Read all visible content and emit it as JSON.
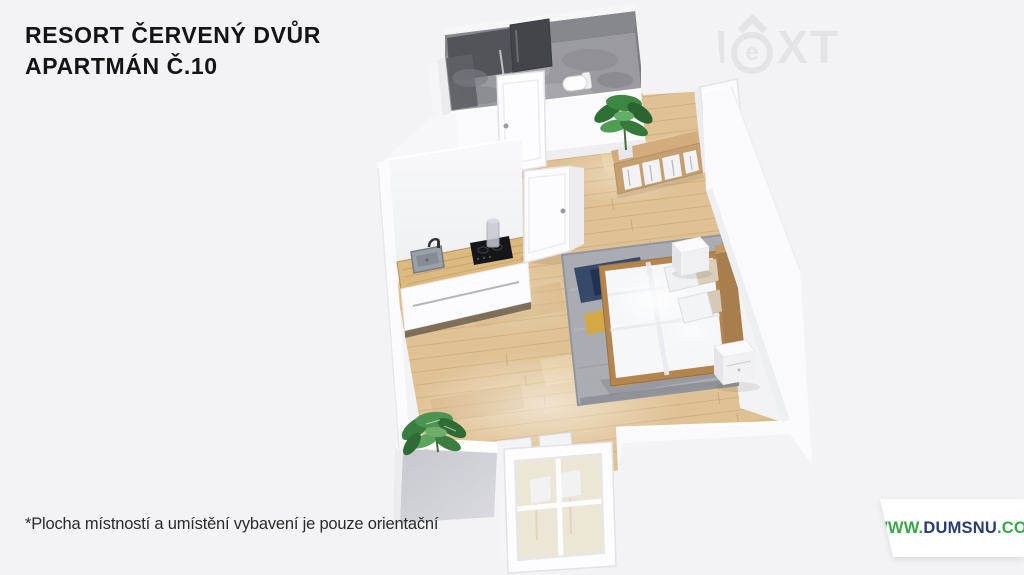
{
  "header": {
    "title_line1": "RESORT ČERVENÝ DVŮR",
    "title_line2": "APARTMÁN Č.10"
  },
  "watermark": {
    "part1": "N",
    "part2": "e",
    "part3": "XT",
    "color": "#e4e4e7"
  },
  "footnote": {
    "text": "*Plocha místností a umístění vybavení je pouze orientační"
  },
  "website": {
    "prefix": "WWW.",
    "domain": "DUMSNU",
    "suffix": ".COM",
    "prefix_color": "#3aa64a",
    "domain_color": "#273f6a"
  },
  "background_color": "#f3f3f5",
  "floor_plan": {
    "view": "3d-isometric-render",
    "rooms": [
      "bathroom",
      "entry-hall",
      "kitchen",
      "bedroom-living-room",
      "balcony-alcove"
    ],
    "furniture": [
      "shower",
      "toilet",
      "bathroom-door",
      "interior-door",
      "kitchen-cabinet",
      "kitchen-sink",
      "cooktop",
      "carafe",
      "open-shelf",
      "potted-plant-entry",
      "potted-plant-living",
      "entry-door",
      "double-bed",
      "pillows",
      "headboard",
      "nightstand-north",
      "nightstand-south",
      "area-rug",
      "dining-chairs",
      "balcony-glass-door"
    ],
    "materials": {
      "wood_floor": "#dfc194",
      "bathroom_tile": "#9a9aa0",
      "shower_tile_dark": "#44444b",
      "wall_white": "#fbfbfd",
      "wall_shadow_gray": "#c9c9d1",
      "counter_wood": "#dcb97e",
      "bed_frame_wood": "#b5854f",
      "rug_gray": "#a8acb3",
      "rug_navy": "#2c4063",
      "rug_yellow": "#e9ba3c",
      "plant_green": "#3d8743"
    }
  }
}
